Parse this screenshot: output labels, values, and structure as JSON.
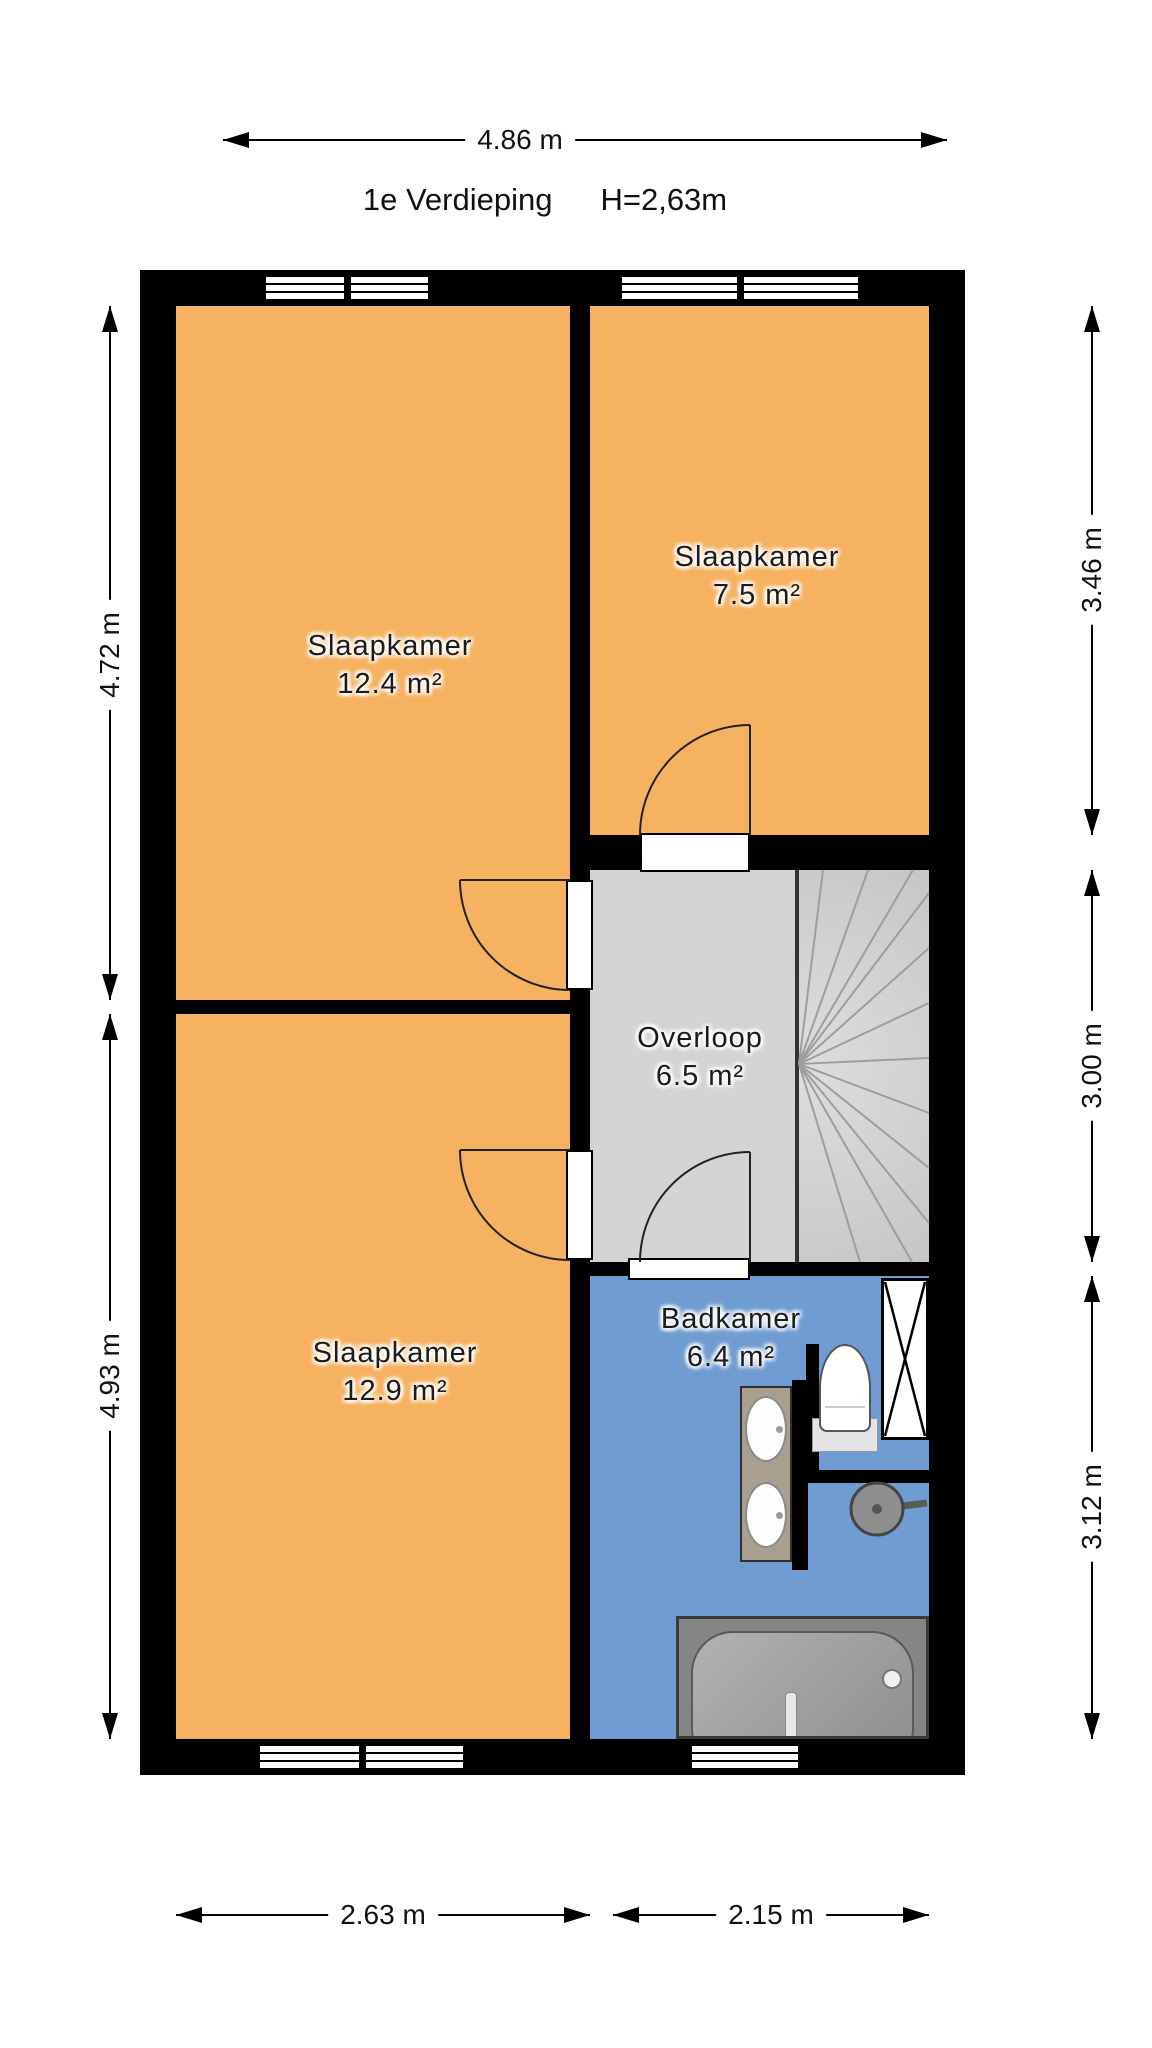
{
  "title": {
    "floor_label": "1e Verdieping",
    "ceiling_height": "H=2,63m"
  },
  "rooms": [
    {
      "name": "Slaapkamer",
      "area": "12.4 m²"
    },
    {
      "name": "Slaapkamer",
      "area": "7.5 m²"
    },
    {
      "name": "Overloop",
      "area": "6.5 m²"
    },
    {
      "name": "Slaapkamer",
      "area": "12.9 m²"
    },
    {
      "name": "Badkamer",
      "area": "6.4 m²"
    }
  ],
  "dimensions": {
    "top_width": "4.86 m",
    "left_upper": "4.72 m",
    "left_lower": "4.93 m",
    "right_upper": "3.46 m",
    "right_middle": "3.00 m",
    "right_lower": "3.12 m",
    "bottom_left": "2.63 m",
    "bottom_right": "2.15 m"
  },
  "fixtures": {
    "staircase": "winder-staircase",
    "bathtub": "bathtub",
    "washbasin": "double-washbasin",
    "toilet": "toilet",
    "shower": "shower-head",
    "shaft": "duct-shaft"
  },
  "colors": {
    "bedroom_floor": "#F6B260",
    "landing_floor": "#D4D4D4",
    "stairs_floor": "#CDCDCD",
    "bathroom_floor": "#6F9DD3",
    "walls": "#000000"
  }
}
